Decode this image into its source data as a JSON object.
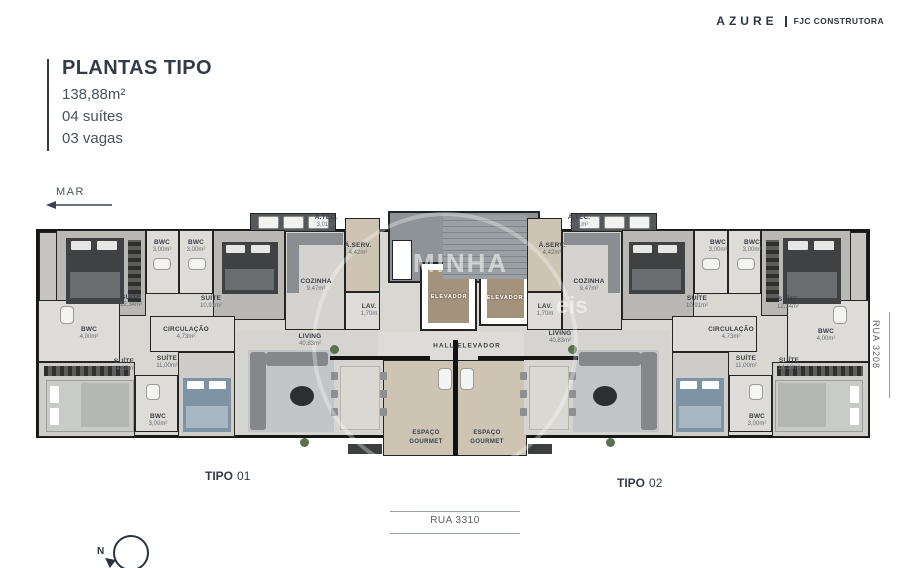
{
  "brand": {
    "name": "AZURE",
    "divider": "|",
    "company": "FJC CONSTRUTORA"
  },
  "header": {
    "title": "PLANTAS TIPO",
    "line1": "138,88m²",
    "line2": "04 suítes",
    "line3": "03 vagas"
  },
  "compass": {
    "sea": "MAR",
    "north": "N"
  },
  "streets": {
    "bottom": "RUA 3310",
    "side": "RUA 3208"
  },
  "units": {
    "tipo1_label": "TIPO",
    "tipo1_number": "01",
    "tipo2_label": "TIPO",
    "tipo2_number": "02"
  },
  "watermark": {
    "word": "MINHA",
    "fragment": "eis"
  },
  "plan": {
    "core": {
      "elevator": "ELEVADOR",
      "hall": "HALL ELEVADOR",
      "gourmet_l1": "ESPAÇO",
      "gourmet_l2": "GOURMET"
    },
    "rooms": {
      "suite_1234": {
        "name": "SUÍTE",
        "area": "12,34m²"
      },
      "suite_1091": {
        "name": "SUÍTE",
        "area": "10,91m²"
      },
      "suite_1418": {
        "name": "SUÍTE",
        "area": "14,18m²"
      },
      "suite_1100": {
        "name": "SUÍTE",
        "area": "11,00m²"
      },
      "bwc_300": {
        "name": "BWC",
        "area": "3,00m²"
      },
      "bwc_400": {
        "name": "BWC",
        "area": "4,00m²"
      },
      "cozinha": {
        "name": "COZINHA",
        "area": "9,47m²"
      },
      "aserv": {
        "name": "Á.SERV.",
        "area": "4,42m²"
      },
      "atec": {
        "name": "Á.TEC.",
        "area": "3,01m²"
      },
      "lav": {
        "name": "LAV.",
        "area": "1,70m"
      },
      "circulacao": {
        "name": "CIRCULAÇÃO",
        "area": "4,73m²"
      },
      "living": {
        "name": "LIVING",
        "area": "40,83m²"
      }
    }
  }
}
